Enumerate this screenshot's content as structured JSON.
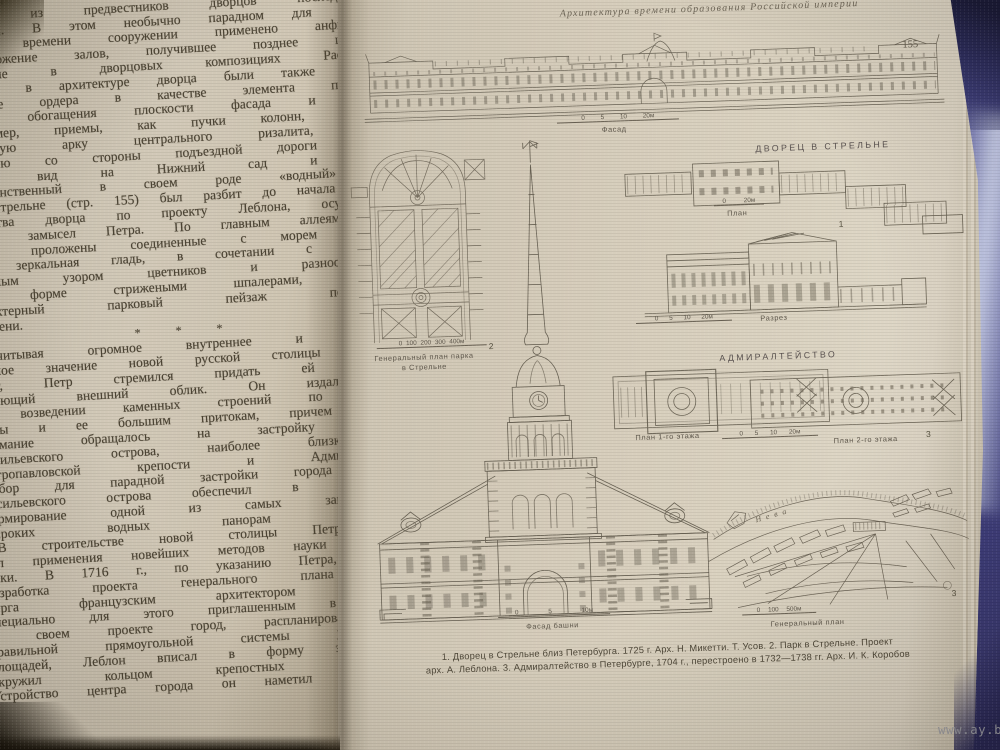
{
  "photo": {
    "watermark": "www.ay.by",
    "fabric_color": "#4c4d97",
    "paper_color": "#d6cdbb",
    "ink_color": "#4c4434"
  },
  "left_page": {
    "lines": [
      "Микетти ...ского дворца ...",
      "одним из предвестников дворцов последующего",
      "периода. В этом необычно парадном для петров-",
      "ского времени сооружении применено анфиладное",
      "расположение залов, получившее позднее широкое",
      "развитие в дворцовых композициях Растрелли.",
      "Новым в архитектуре дворца были также исполь-",
      "зование ордера в качестве элемента пластиче-",
      "ского обогащения плоскости фасада и такие,",
      "например, приемы, как пучки колонн, несущие",
      "сквозную арку центрального ризалита, через",
      "которую со стороны подъездной дороги откры-",
      "вался вид на Нижний сад и море.",
      " Единственный в своем роде «водный» сад",
      "в Стрельне (стр. 155) был разбит до начала строи-",
      "тельства дворца по проекту Леблона, осуществив-",
      "шему замысел Петра. По главным аллеям сада",
      "были проложены соединенные с морем каналы.",
      "Их зеркальная гладь, в сочетании с орнамен-",
      "тальным узором цветников и разнообразными",
      "по форме стрижеными шпалерами, создавал",
      "характерный парковый пейзаж петровского",
      "времени.",
      "*  *  *",
      " Учитывая огромное внутреннее и междуна-",
      "родное значение новой русской столицы и ее",
      "рост, Петр стремился придать ей соответ-",
      "ствующий внешний облик. Он издал указ",
      "о возведении каменных строений по берегам",
      "Невы и ее большим притокам, причем главное",
      "внимание обращалось на застройку стрелки",
      "Васильевского острова, наиболее близкой к",
      "Петропавловской крепости и Адмиралтейству.",
      "Выбор для парадной застройки города кромки",
      "Васильевского острова обеспечил в дальнейшем",
      "формирование одной из самых замечательных",
      "широких водных панорам Петербурга.",
      " В строительстве новой столицы Петр требо-",
      "вал применения новейших методов науки и тех-",
      "ники. В 1716 г., по указанию Петра, началась",
      "разработка проекта генерального плана Петер-",
      "бурга французским архитектором Леблоном,",
      "специально для этого приглашенным в Россию.",
      "В своем проекте город, распланированный в",
      "правильной прямоугольной системы улиц и",
      "площадей, Леблон вписал в форму эллипса и",
      "окружил кольцом крепостных сооружений.",
      "Устройство центра города он наметил в глубине"
    ]
  },
  "right_page": {
    "header": "Архитектура времени образования Российской империи",
    "page_number": "155",
    "figs": {
      "facade": {
        "scale": "0 5 10 20м",
        "label": "Фасад"
      },
      "strelna": {
        "title": "ДВОРЕЦ В СТРЕЛЬНЕ",
        "plan_scale": "0 20м",
        "plan_label": "План",
        "fig_no": "1",
        "section_scale": "0 5 10 20м",
        "section_label": "Разрез"
      },
      "park": {
        "scale": "0 100 200 300 400м",
        "fig_no": "2",
        "label1": "Генеральный план парка",
        "label2": "в Стрельне"
      },
      "admiralty": {
        "title": "АДМИРАЛТЕЙСТВО",
        "plan1_label": "План 1-го этажа",
        "scale": "0 5 10 20м",
        "plan2_label": "План 2-го этажа",
        "fig_no": "3"
      },
      "tower": {
        "scale": "0 5 10м",
        "label": "Фасад башни"
      },
      "genplan": {
        "scale": "0 100 500м",
        "label": "Генеральный план",
        "fig_no": "3",
        "river": "Нева"
      }
    },
    "caption_line1": "1. Дворец в Стрельне близ Петербурга. 1725 г. Арх. Н. Микетти. Т. Усов. 2. Парк в Стрельне. Проект",
    "caption_line2": "арх. А. Леблона. 3. Адмиралтейство в Петербурге, 1704 г., перестроено в 1732—1738 гг. Арх. И. К. Коробов"
  }
}
